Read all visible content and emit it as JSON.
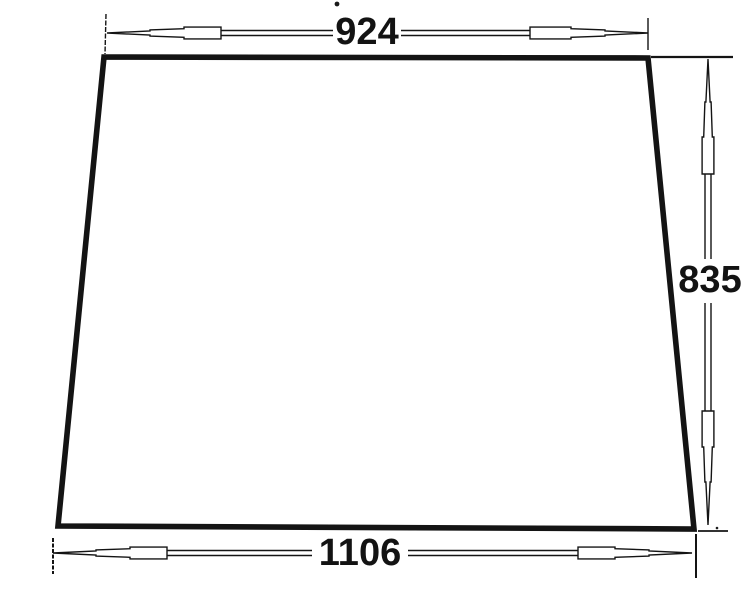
{
  "drawing": {
    "shape": "trapezoid",
    "dimensions": {
      "top_width": "924",
      "side_height": "835",
      "bottom_width": "1106"
    },
    "colors": {
      "ink": "#141414",
      "background": "#ffffff"
    }
  }
}
